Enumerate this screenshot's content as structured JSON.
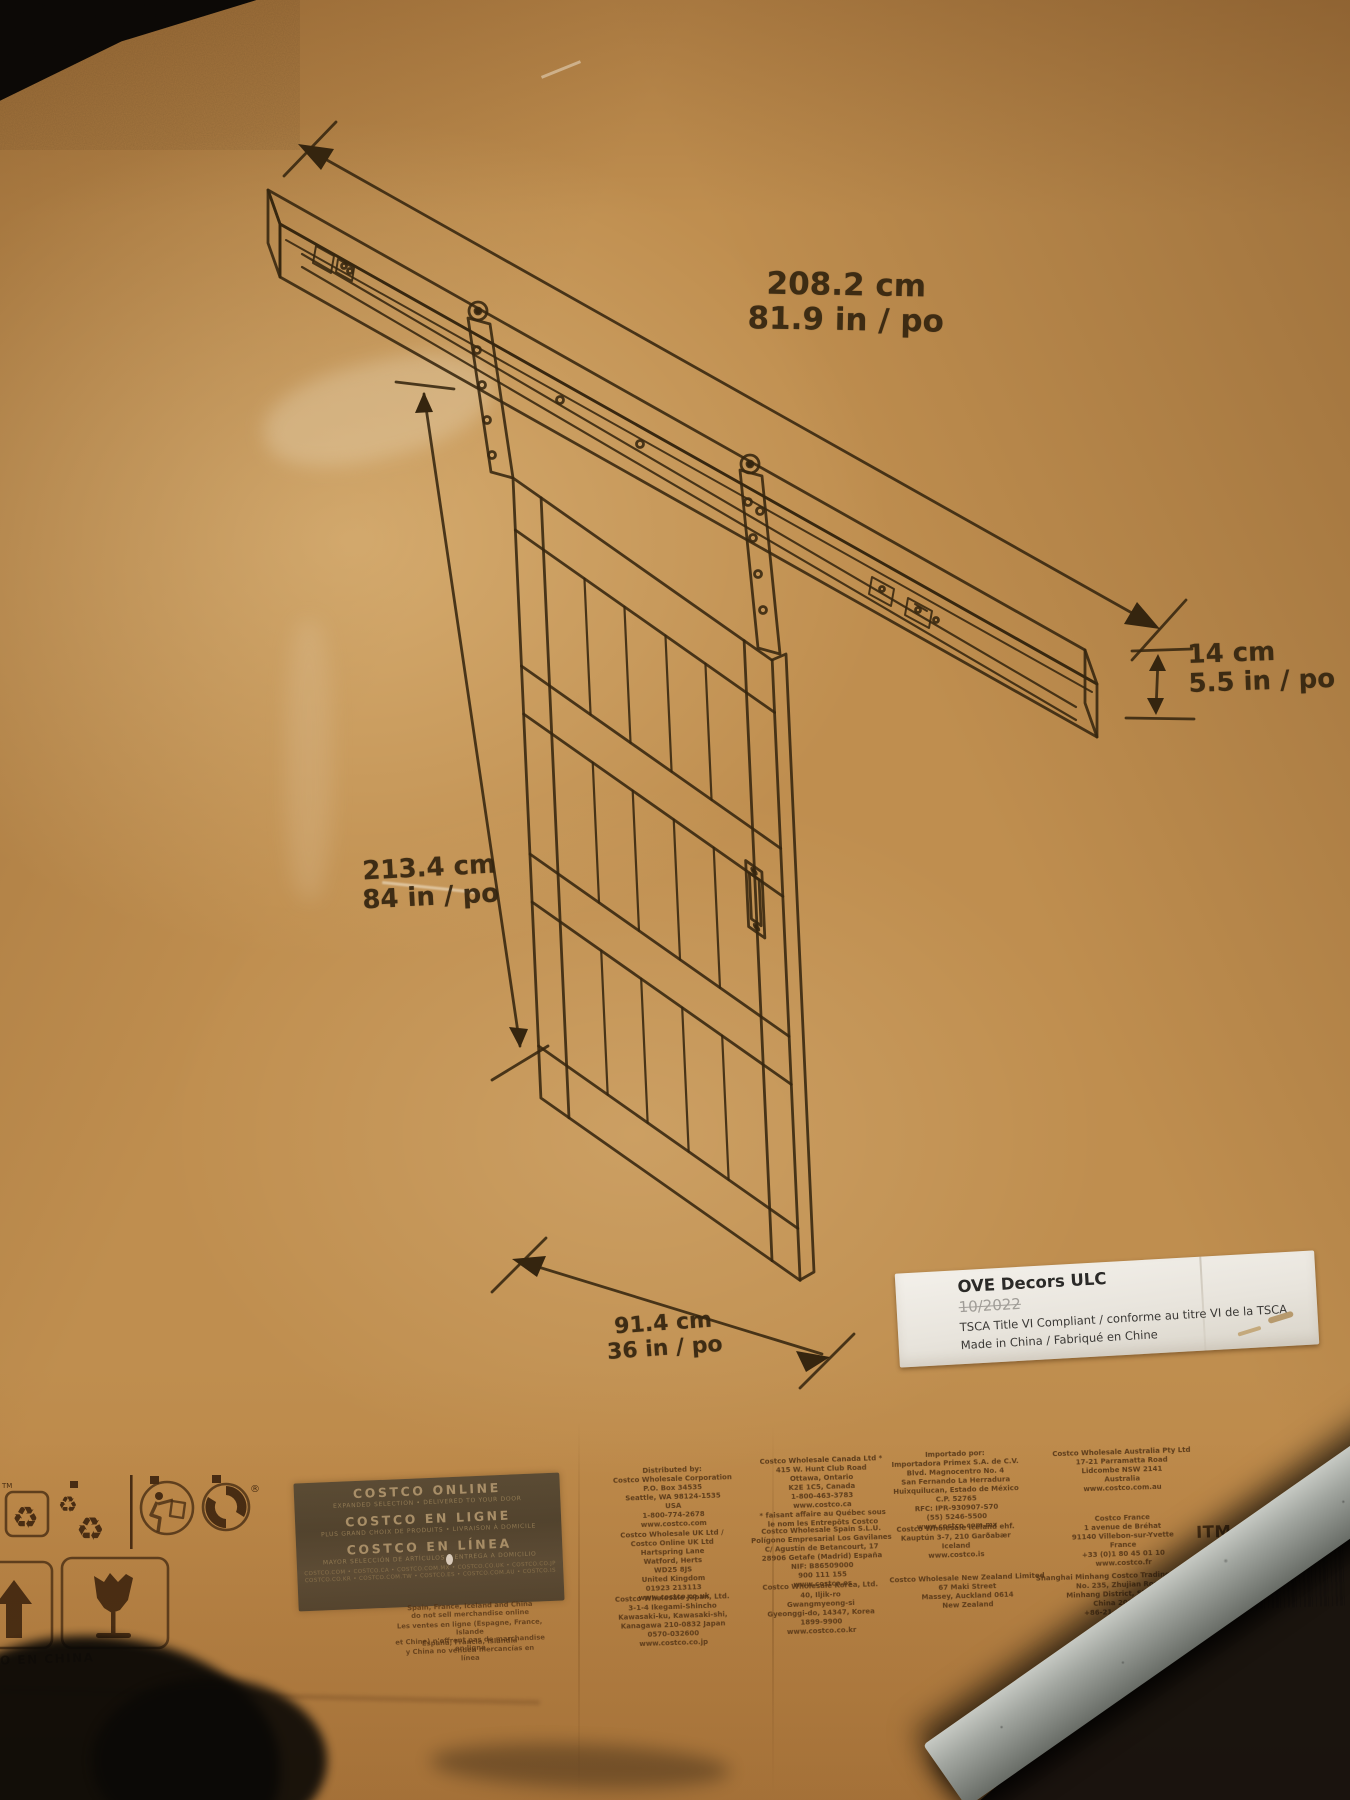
{
  "colors": {
    "cardboard": "#bf8e4f",
    "ink": "#35250f",
    "sticker": "#ece8e1",
    "railing": "#9aa09a"
  },
  "dims": {
    "rail_length": {
      "metric": "208.2 cm",
      "imperial": "81.9 in / po"
    },
    "rail_height": {
      "metric": "14 cm",
      "imperial": "5.5 in / po"
    },
    "door_height": {
      "metric": "213.4 cm",
      "imperial": "84 in / po"
    },
    "door_width": {
      "metric": "91.4 cm",
      "imperial": "36 in / po"
    }
  },
  "sticker": {
    "company": "OVE Decors ULC",
    "date": "10/2022",
    "compliance": "TSCA Title VI Compliant / conforme au titre VI de la TSCA",
    "origin": "Made in China / Fabriqué en Chine"
  },
  "online_panel": {
    "en_title": "COSTCO ONLINE",
    "en_sub": "EXPANDED SELECTION • DELIVERED TO YOUR DOOR",
    "fr_title": "COSTCO EN LIGNE",
    "fr_sub": "PLUS GRAND CHOIX DE PRODUITS • LIVRAISON À DOMICILE",
    "es_title": "COSTCO EN LÍNEA",
    "es_sub": "MAYOR SELECCIÓN DE ARTÍCULOS • ENTREGA A DOMICILIO",
    "sites_1": "COSTCO.COM • COSTCO.CA • COSTCO.COM.MX • COSTCO.CO.UK • COSTCO.CO.JP",
    "sites_2": "COSTCO.CO.KR • COSTCO.COM.TW • COSTCO.ES • COSTCO.COM.AU • COSTCO.IS"
  },
  "online_notes": {
    "en": [
      "Spain, France, Iceland and China",
      "do not sell merchandise online"
    ],
    "fr": [
      "Les ventes en ligne (Espagne, France, Islande",
      "et Chine) n'offrent pas de marchandise en ligne"
    ],
    "es": [
      "España, Francia, Islandia",
      "y China no venden mercancías en línea"
    ]
  },
  "addresses": {
    "col1": {
      "block1": [
        "Distributed by:",
        "Costco Wholesale Corporation",
        "P.O. Box 34535",
        "Seattle, WA 98124-1535",
        "USA",
        "1-800-774-2678",
        "www.costco.com"
      ],
      "block2": [
        "Costco Wholesale UK Ltd /",
        "Costco Online UK Ltd",
        "Hartspring Lane",
        "Watford, Herts",
        "WD25 8JS",
        "United Kingdom",
        "01923 213113",
        "www.costco.co.uk"
      ],
      "block3": [
        "Costco Wholesale Japan, Ltd.",
        "3-1-4 Ikegami-Shincho",
        "Kawasaki-ku, Kawasaki-shi,",
        "Kanagawa 210-0832 Japan",
        "0570-032600",
        "www.costco.co.jp"
      ]
    },
    "col2": {
      "block1": [
        "Costco Wholesale Canada Ltd *",
        "415 W. Hunt Club Road",
        "Ottawa, Ontario",
        "K2E 1C5, Canada",
        "1-800-463-3783",
        "www.costco.ca",
        "* faisant affaire au Québec sous",
        "le nom les Entrepôts Costco"
      ],
      "block2": [
        "Costco Wholesale Spain S.L.U.",
        "Polígono Empresarial Los Gavilanes",
        "C/ Agustín de Betancourt, 17",
        "28906 Getafe (Madrid) España",
        "NIF: B86509000",
        "900 111 155",
        "www.costco.es"
      ],
      "block3": [
        "Costco Wholesale Korea, Ltd.",
        "40, Iljik-ro",
        "Gwangmyeong-si",
        "Gyeonggi-do, 14347, Korea",
        "1899-9900",
        "www.costco.co.kr"
      ]
    },
    "col3": {
      "block1": [
        "Importado por:",
        "Importadora Primex S.A. de C.V.",
        "Blvd. Magnocentro No. 4",
        "San Fernando La Herradura",
        "Huixquilucan, Estado de México",
        "C.P. 52765",
        "RFC: IPR-930907-S70",
        "(55) 5246-5500",
        "www.costco.com.mx"
      ],
      "block2": [
        "Costco Wholesale Iceland ehf.",
        "Kauptún 3-7, 210 Garðabær",
        "Iceland",
        "www.costco.is"
      ],
      "block3": [
        "Costco Wholesale New Zealand Limited",
        "67 Maki Street",
        "Massey, Auckland 0614",
        "New Zealand"
      ]
    },
    "col4": {
      "block1": [
        "Costco Wholesale Australia Pty Ltd",
        "17-21 Parramatta Road",
        "Lidcombe NSW 2141",
        "Australia",
        "www.costco.com.au"
      ],
      "block2": [
        "Costco France",
        "1 avenue de Bréhat",
        "91140 Villebon-sur-Yvette",
        "France",
        "+33 (0)1 80 45 01 10",
        "www.costco.fr"
      ],
      "block3": [
        "Shanghai Minhang Costco Trading Co., Ltd",
        "No. 235, Zhujian Road",
        "Minhang District, Shanghai",
        "China 201106",
        "+86-21-6257-7086"
      ]
    }
  },
  "item": {
    "label": "ITM. / ART.",
    "number": "1600323"
  },
  "barcode_digits": "8 28 9",
  "origin_stamp": "O EN CHINA",
  "marks": {
    "tm": "TM",
    "registered": "®"
  }
}
